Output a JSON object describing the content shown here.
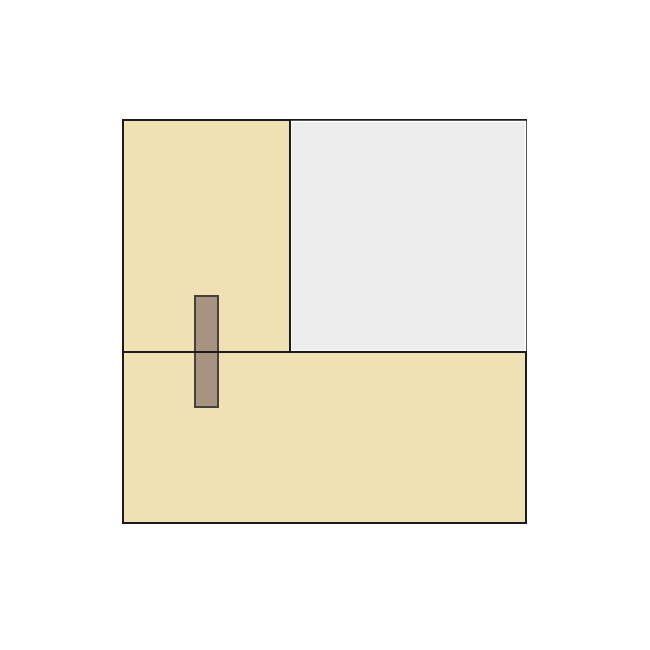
{
  "canvas": {
    "width": 650,
    "height": 650,
    "background": "#ffffff"
  },
  "colors": {
    "tan_fill": "#F0E1B5",
    "gray_fill": "#EDEDED",
    "brown_fill": "#A69480",
    "outline_black": "#1B1B1B",
    "brown_outline": "#45423B",
    "gray_inset_stroke": "#FFFFFF"
  },
  "diagram": {
    "outer_square": {
      "x": 123,
      "y": 120,
      "width": 403,
      "height": 403,
      "fill": "#F0E1B5",
      "stroke": "#1B1B1B",
      "stroke_width": 2
    },
    "gray_panel": {
      "x": 291,
      "y": 121.5,
      "width": 234.5,
      "height": 229.5,
      "fill": "#EDEDED",
      "stroke": "#FFFFFF",
      "stroke_width": 1.5
    },
    "brown_bar": {
      "x": 195,
      "y": 296,
      "width": 23,
      "height": 111,
      "fill": "#A69480",
      "stroke": "#45423B",
      "stroke_width": 2
    },
    "vertical_divider": {
      "x1": 290,
      "y1": 120,
      "x2": 290,
      "y2": 352,
      "color": "#1B1B1B",
      "width": 2
    },
    "horizontal_divider": {
      "x1": 122,
      "y1": 352,
      "x2": 527,
      "y2": 352,
      "color": "#1B1B1B",
      "width": 2
    }
  }
}
